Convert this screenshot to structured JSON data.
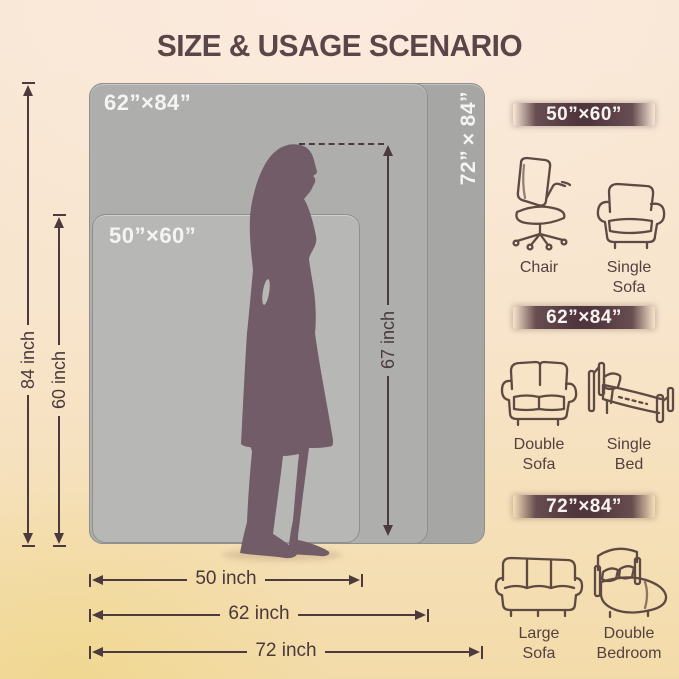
{
  "title": "SIZE & USAGE SCENARIO",
  "colors": {
    "background_top": "#f8e6d4",
    "background_bottom": "#f3dba9",
    "title_text": "#5c4549",
    "rect_72": "#a6a7a5",
    "rect_62": "#aeafad",
    "rect_50": "#b7b8b6",
    "rect_label_text": "#f4f4f2",
    "silhouette": "#715c67",
    "dimension_lines": "#4d3a3f",
    "badge_background": "#4f353c",
    "badge_text": "#f7f2ef",
    "icon_stroke": "#5f4a43"
  },
  "diagram": {
    "rect_labels": {
      "r62": "62”×84”",
      "r50": "50”×60”",
      "r72": "72”×84”"
    },
    "silhouette": "standing-woman",
    "dims": {
      "v84": "84 inch",
      "v60": "60 inch",
      "v67": "67 inch",
      "h50": "50 inch",
      "h62": "62 inch",
      "h72": "72 inch"
    }
  },
  "scenarios": [
    {
      "size": "50”×60”",
      "items": [
        {
          "icon": "office-chair-icon",
          "label": "Chair"
        },
        {
          "icon": "single-sofa-icon",
          "label": "Single\nSofa"
        }
      ]
    },
    {
      "size": "62”×84”",
      "items": [
        {
          "icon": "double-sofa-icon",
          "label": "Double\nSofa"
        },
        {
          "icon": "single-bed-icon",
          "label": "Single\nBed"
        }
      ]
    },
    {
      "size": "72”×84”",
      "items": [
        {
          "icon": "large-sofa-icon",
          "label": "Large\nSofa"
        },
        {
          "icon": "double-bed-icon",
          "label": "Double\nBedroom"
        }
      ]
    }
  ]
}
